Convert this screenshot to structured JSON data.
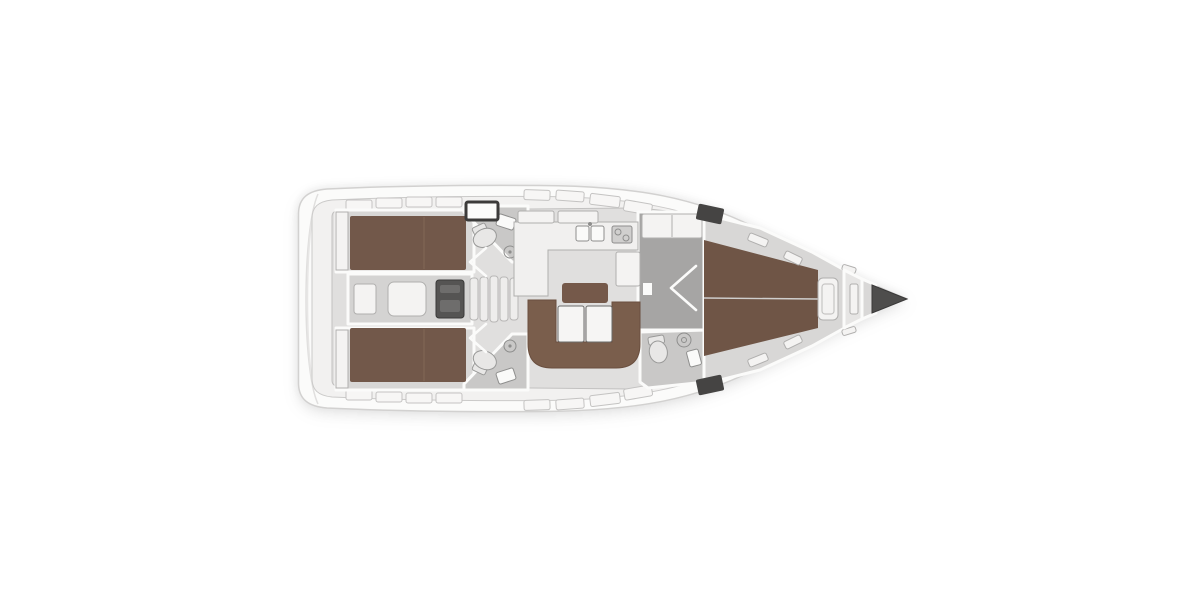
{
  "plan": {
    "label": "Sailing yacht interior layout floor plan, top view, bow pointing right",
    "orientation": "bow-right",
    "areas": [
      "aft cabin port",
      "aft cabin starboard",
      "aft head port",
      "aft head starboard",
      "engine compartment",
      "companionway stairs",
      "galley",
      "salon",
      "corridor",
      "forward head",
      "forward cabin v-berth",
      "anchor locker",
      "bow"
    ]
  },
  "colors": {
    "background": "#ffffff",
    "hull": "#fbfbfa",
    "hull_stroke": "#d2d1d0",
    "deck": "#f2f1f0",
    "deck_stroke": "#cbcac9",
    "interior": "#e0dfde",
    "interior_stroke": "#c2c1c0",
    "cabin_floor": "#d8d7d6",
    "head_floor": "#c9c8c7",
    "corridor_floor": "#a6a5a4",
    "engine_room_floor": "#d4d3d2",
    "bed": "#72584a",
    "bed_seam": "#7f6554",
    "bed_forward": "#6f5546",
    "sofa": "#7a5e4c",
    "sofa_stroke": "#6a4f3f",
    "ottoman": "#75594a",
    "table": "#f6f5f4",
    "table_stroke": "#6b6a69",
    "fixture": "#f4f3f2",
    "counter": "#f1f0ef",
    "sink": "#fafaf9",
    "stove": "#d0cfce",
    "appliance_stroke": "#8e8e8d",
    "engine": "#555453",
    "engine_stroke": "#3a3a39",
    "engine_detail": "#6e6d6c",
    "stairs": "#eeedec",
    "window": "#f7f6f5",
    "hatch_frame": "#3c3b3a",
    "hatch_dark": "#454443",
    "bow_bulkhead": "#e6e5e4",
    "bow_wedge": "#d9d8d7",
    "bow_tip": "#4e4d4c",
    "bow_tip_stroke": "#3a3939",
    "wall": "#fbfbfa",
    "door": "#fbfbfa",
    "toilet": "#e8e7e6",
    "toilet_stroke": "#9a9a99",
    "seam": "#cfcecd",
    "transom_line": "#e0dfde",
    "platform_line": "#e7e6e5",
    "inner_frame": "#c6c5c4"
  }
}
